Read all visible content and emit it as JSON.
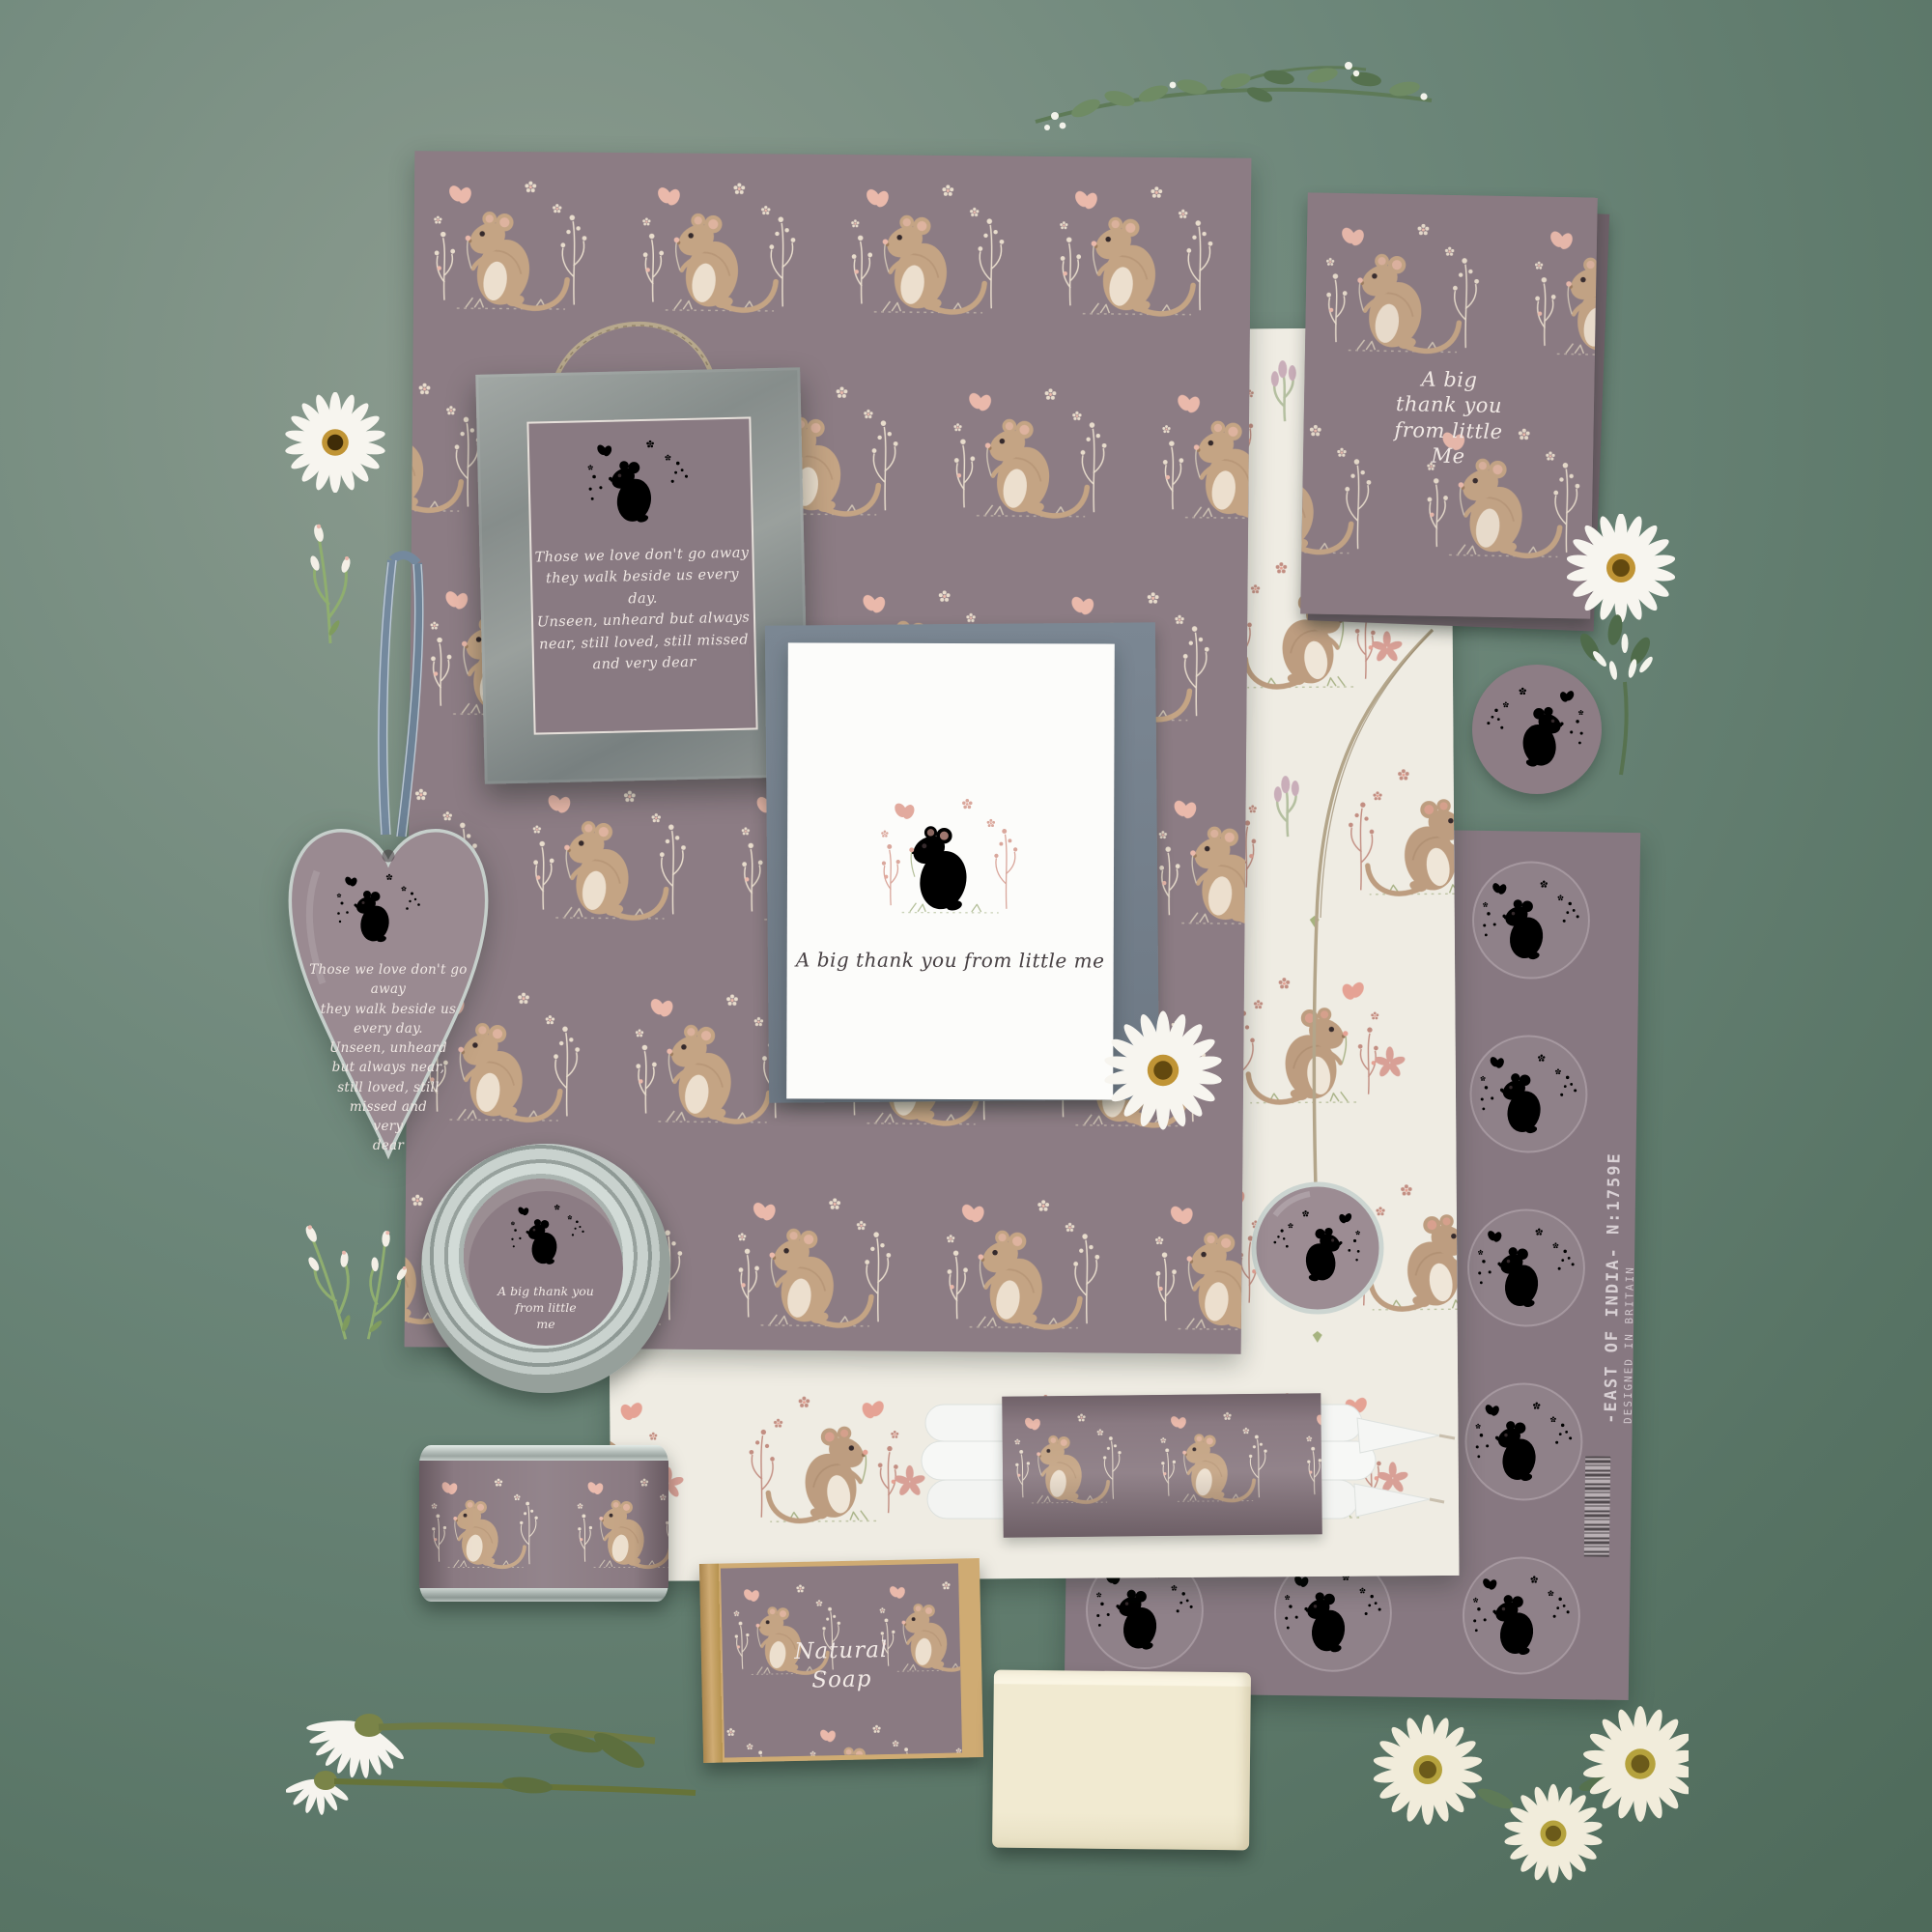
{
  "palette": {
    "background_green": "#5e7a6b",
    "paper_mauve": "#8c7c84",
    "tissue_cream": "#efece3",
    "card_white": "#fcfcfa",
    "envelope_grey_blue": "#76818d",
    "frame_wood_grey": "#8d9392",
    "ribbon_blue_grey": "#74899e",
    "twine_brown": "#b3a58a",
    "tin_silver": "#c2cbc7",
    "kraft_brown": "#c49e66",
    "soap_cream": "#f1ebd3",
    "candle_white": "#f7f8f6",
    "mouse_fur_brown": "#c4a484",
    "blossom_pink": "#eab9ab",
    "daisy_white": "#f6f4ee",
    "daisy_center_gold": "#c09435",
    "leaf_green": "#5e7a57"
  },
  "texts": {
    "frame_verse": [
      "Those we love don't go away",
      "they walk beside us every day.",
      "Unseen, unheard but always",
      "near, still loved, still missed",
      "and very dear"
    ],
    "heart_verse": [
      "Those we love don't go away",
      "they walk beside us every day.",
      "Unseen, unheard",
      "but always near,",
      "still loved, still",
      "missed and",
      "very",
      "dear"
    ],
    "card_caption": "A big thank you from little me",
    "notebook_caption": [
      "A big",
      "thank you",
      "from little",
      "Me"
    ],
    "lid_caption": [
      "A big thank you",
      "from little",
      "me"
    ],
    "soap_label": [
      "Natural",
      "Soap"
    ],
    "brand": "-EAST OF INDIA-",
    "origin": "DESIGNED IN BRITAIN",
    "product_code": "N:1759E"
  }
}
